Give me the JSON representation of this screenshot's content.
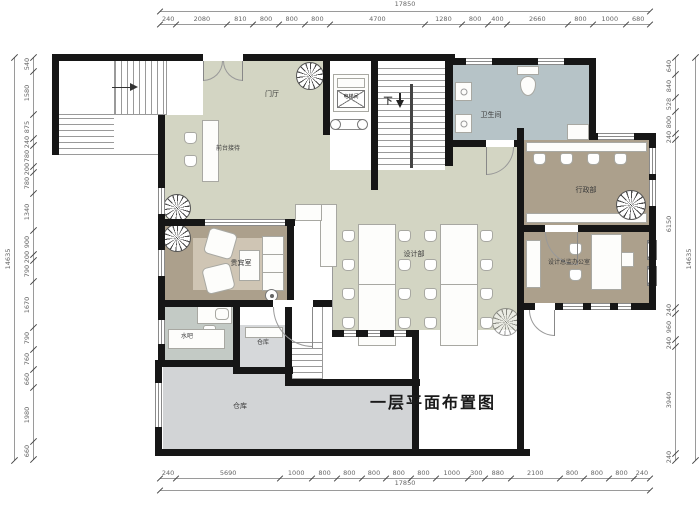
{
  "title": "一层平面布置图",
  "rooms": {
    "entrance_hall": "门厅",
    "reception": "前台接待",
    "elevator": "电梯间",
    "stair_down": "下",
    "bathroom": "卫生间",
    "admin": "行政部",
    "vip": "贵宾室",
    "design": "设计部",
    "director": "设计总监办公室",
    "water_bar": "水吧",
    "storage": "仓库",
    "warehouse": "仓库"
  },
  "dimensions": {
    "overall_width": "17850",
    "overall_height": "14635",
    "top": [
      240,
      2080,
      810,
      800,
      800,
      800,
      4700,
      1280,
      800,
      400,
      2660,
      800,
      1000,
      680
    ],
    "bottom": [
      240,
      5690,
      1000,
      800,
      800,
      800,
      800,
      800,
      1000,
      300,
      880,
      2100,
      800,
      800,
      800,
      240
    ],
    "left": [
      540,
      1580,
      875,
      240,
      780,
      200,
      780,
      1340,
      900,
      200,
      790,
      1670,
      790,
      760,
      660,
      1980,
      660
    ],
    "right": [
      640,
      840,
      528,
      800,
      240,
      6150,
      240,
      960,
      240,
      3940,
      240
    ]
  },
  "colors": {
    "wall": "#161616",
    "floor": "#d3d5c3",
    "room_tan": "#aca08c",
    "vip_rug": "#cfc5b4",
    "bathroom": "#b6c3c7",
    "water_bar": "#c3cac5",
    "storage": "#d6d8da",
    "warehouse": "#d2d4d6"
  }
}
